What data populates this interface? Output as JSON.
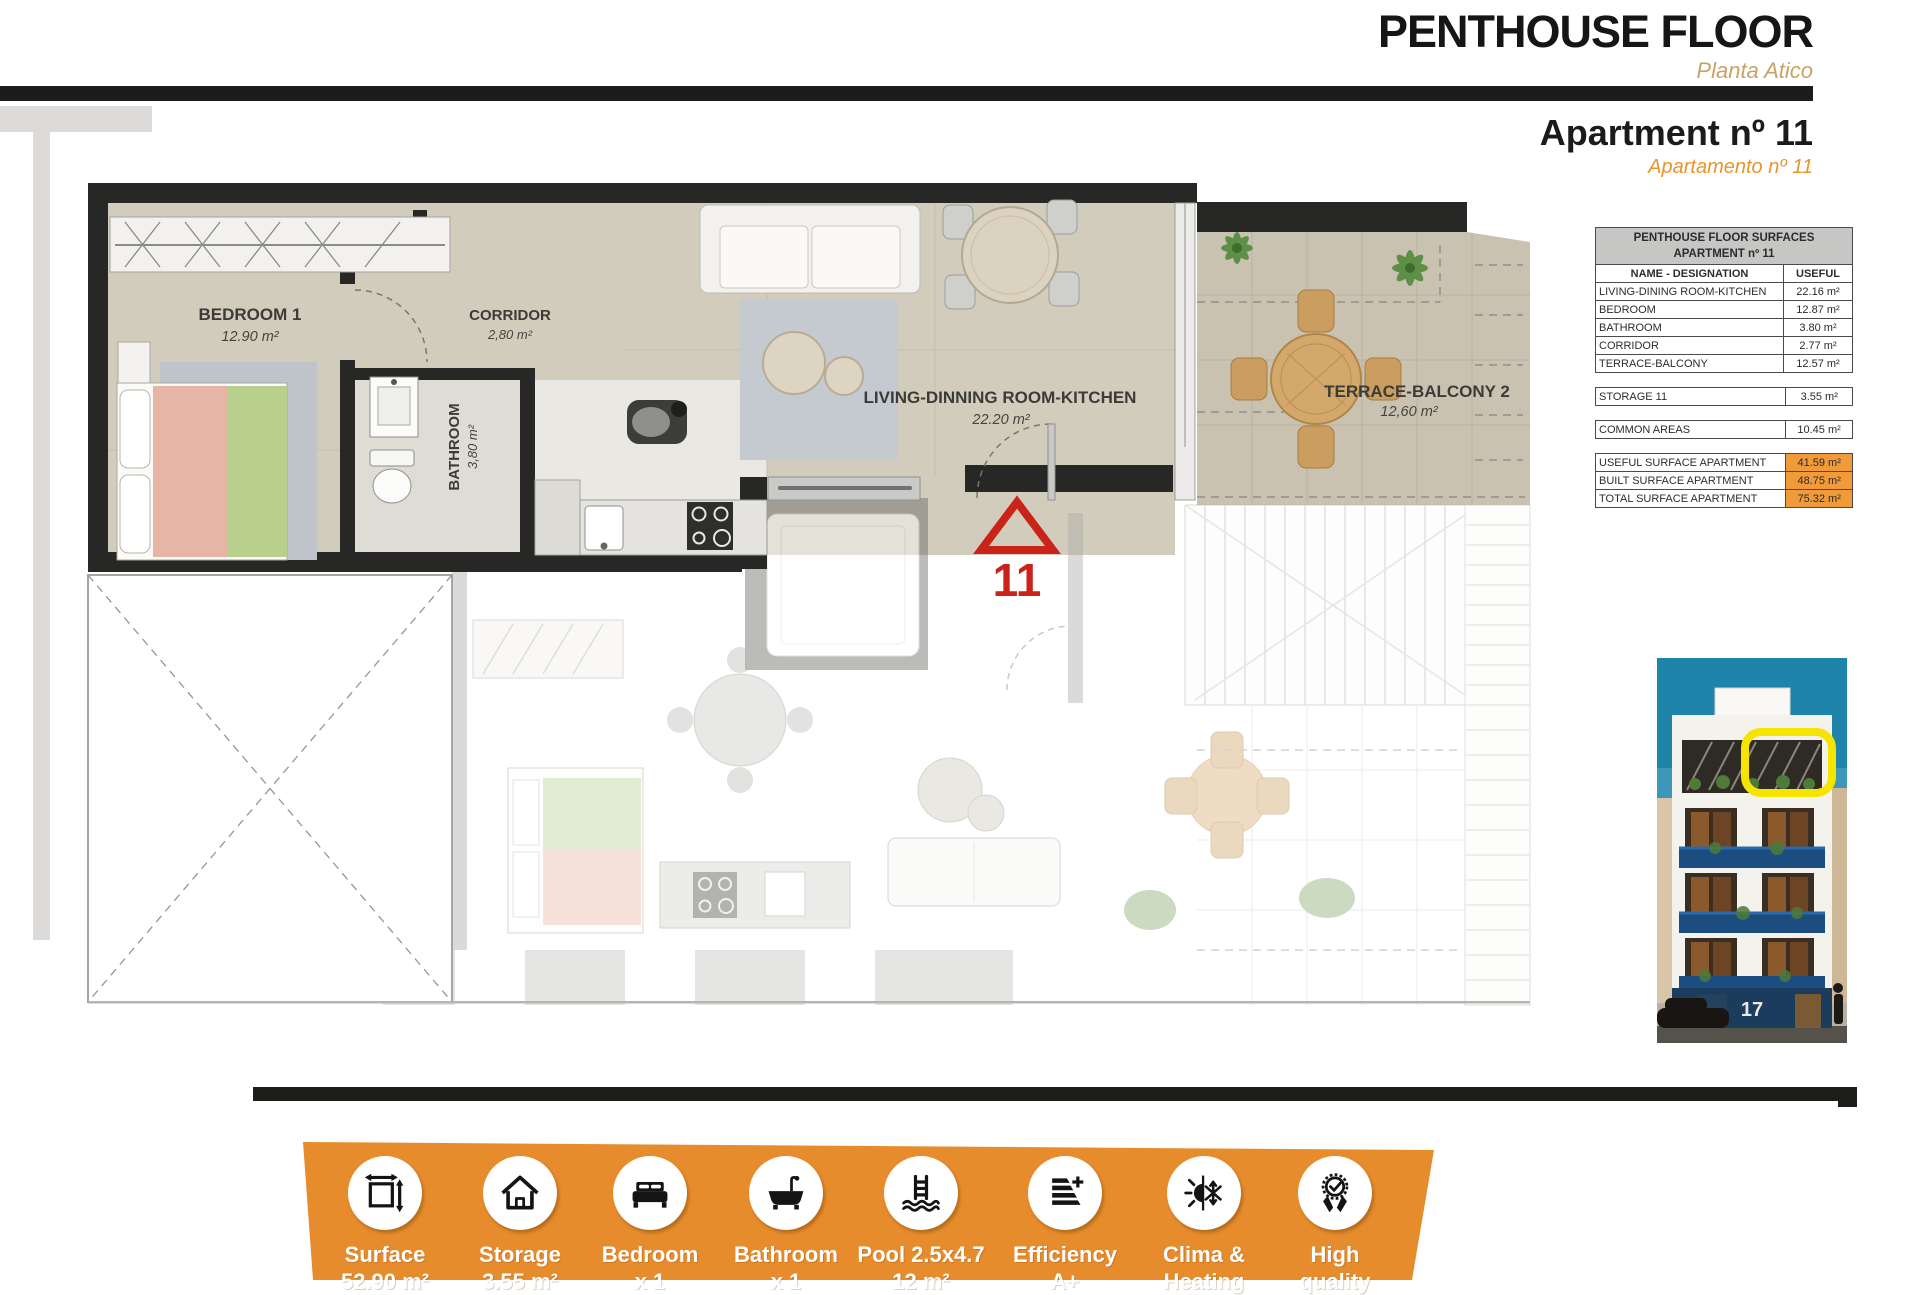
{
  "header": {
    "title": "PENTHOUSE FLOOR",
    "subtitle": "Planta Atico",
    "apartment_title": "Apartment nº 11",
    "apartment_subtitle": "Apartamento nº 11"
  },
  "plan": {
    "bedroom1": {
      "name": "BEDROOM 1",
      "area": "12.90 m²"
    },
    "corridor": {
      "name": "CORRIDOR",
      "area": "2,80 m²"
    },
    "bathroom": {
      "name": "BATHROOM",
      "area": "3,80 m²"
    },
    "living": {
      "name": "LIVING-DINNING ROOM-KITCHEN",
      "area": "22.20 m²"
    },
    "terrace": {
      "name": "TERRACE-BALCONY 2",
      "area": "12,60 m²"
    },
    "unit_marker": "11"
  },
  "surfaces_table": {
    "title_line1": "PENTHOUSE FLOOR SURFACES",
    "title_line2": "APARTMENT nº 11",
    "col_name": "NAME - DESIGNATION",
    "col_useful": "USEFUL",
    "rows": [
      {
        "name": "LIVING-DINING ROOM-KITCHEN",
        "value": "22.16 m²"
      },
      {
        "name": "BEDROOM",
        "value": "12.87 m²"
      },
      {
        "name": "BATHROOM",
        "value": "3.80 m²"
      },
      {
        "name": "CORRIDOR",
        "value": "2.77 m²"
      },
      {
        "name": "TERRACE-BALCONY",
        "value": "12.57 m²"
      }
    ],
    "storage": {
      "name": "STORAGE 11",
      "value": "3.55 m²"
    },
    "common": {
      "name": "COMMON AREAS",
      "value": "10.45 m²"
    },
    "summary": [
      {
        "name": "USEFUL SURFACE APARTMENT",
        "value": "41.59 m²"
      },
      {
        "name": "BUILT SURFACE APARTMENT",
        "value": "48.75 m²"
      },
      {
        "name": "TOTAL SURFACE APARTMENT",
        "value": "75.32 m²"
      }
    ]
  },
  "building": {
    "number": "17"
  },
  "banner": {
    "items": [
      {
        "id": "surface",
        "line1": "Surface",
        "line2": "52.90 m²"
      },
      {
        "id": "storage",
        "line1": "Storage",
        "line2": "3.55 m²"
      },
      {
        "id": "bedroom",
        "line1": "Bedroom",
        "line2": "x 1"
      },
      {
        "id": "bathroom",
        "line1": "Bathroom",
        "line2": "x 1"
      },
      {
        "id": "pool",
        "line1": "Pool 2.5x4.7",
        "line2": "12 m²"
      },
      {
        "id": "efficiency",
        "line1": "Efficiency",
        "line2": "A+"
      },
      {
        "id": "clima",
        "line1": "Clima &",
        "line2": "Heating"
      },
      {
        "id": "quality",
        "line1": "High",
        "line2": "quality"
      }
    ]
  },
  "colors": {
    "banner_orange": "#e78c2c",
    "table_orange": "#f09a3a",
    "subtitle_tan": "#c9a266",
    "subtitle_orange": "#e8952f",
    "marker_red": "#c9231a",
    "highlight_yellow": "#f4e400"
  }
}
